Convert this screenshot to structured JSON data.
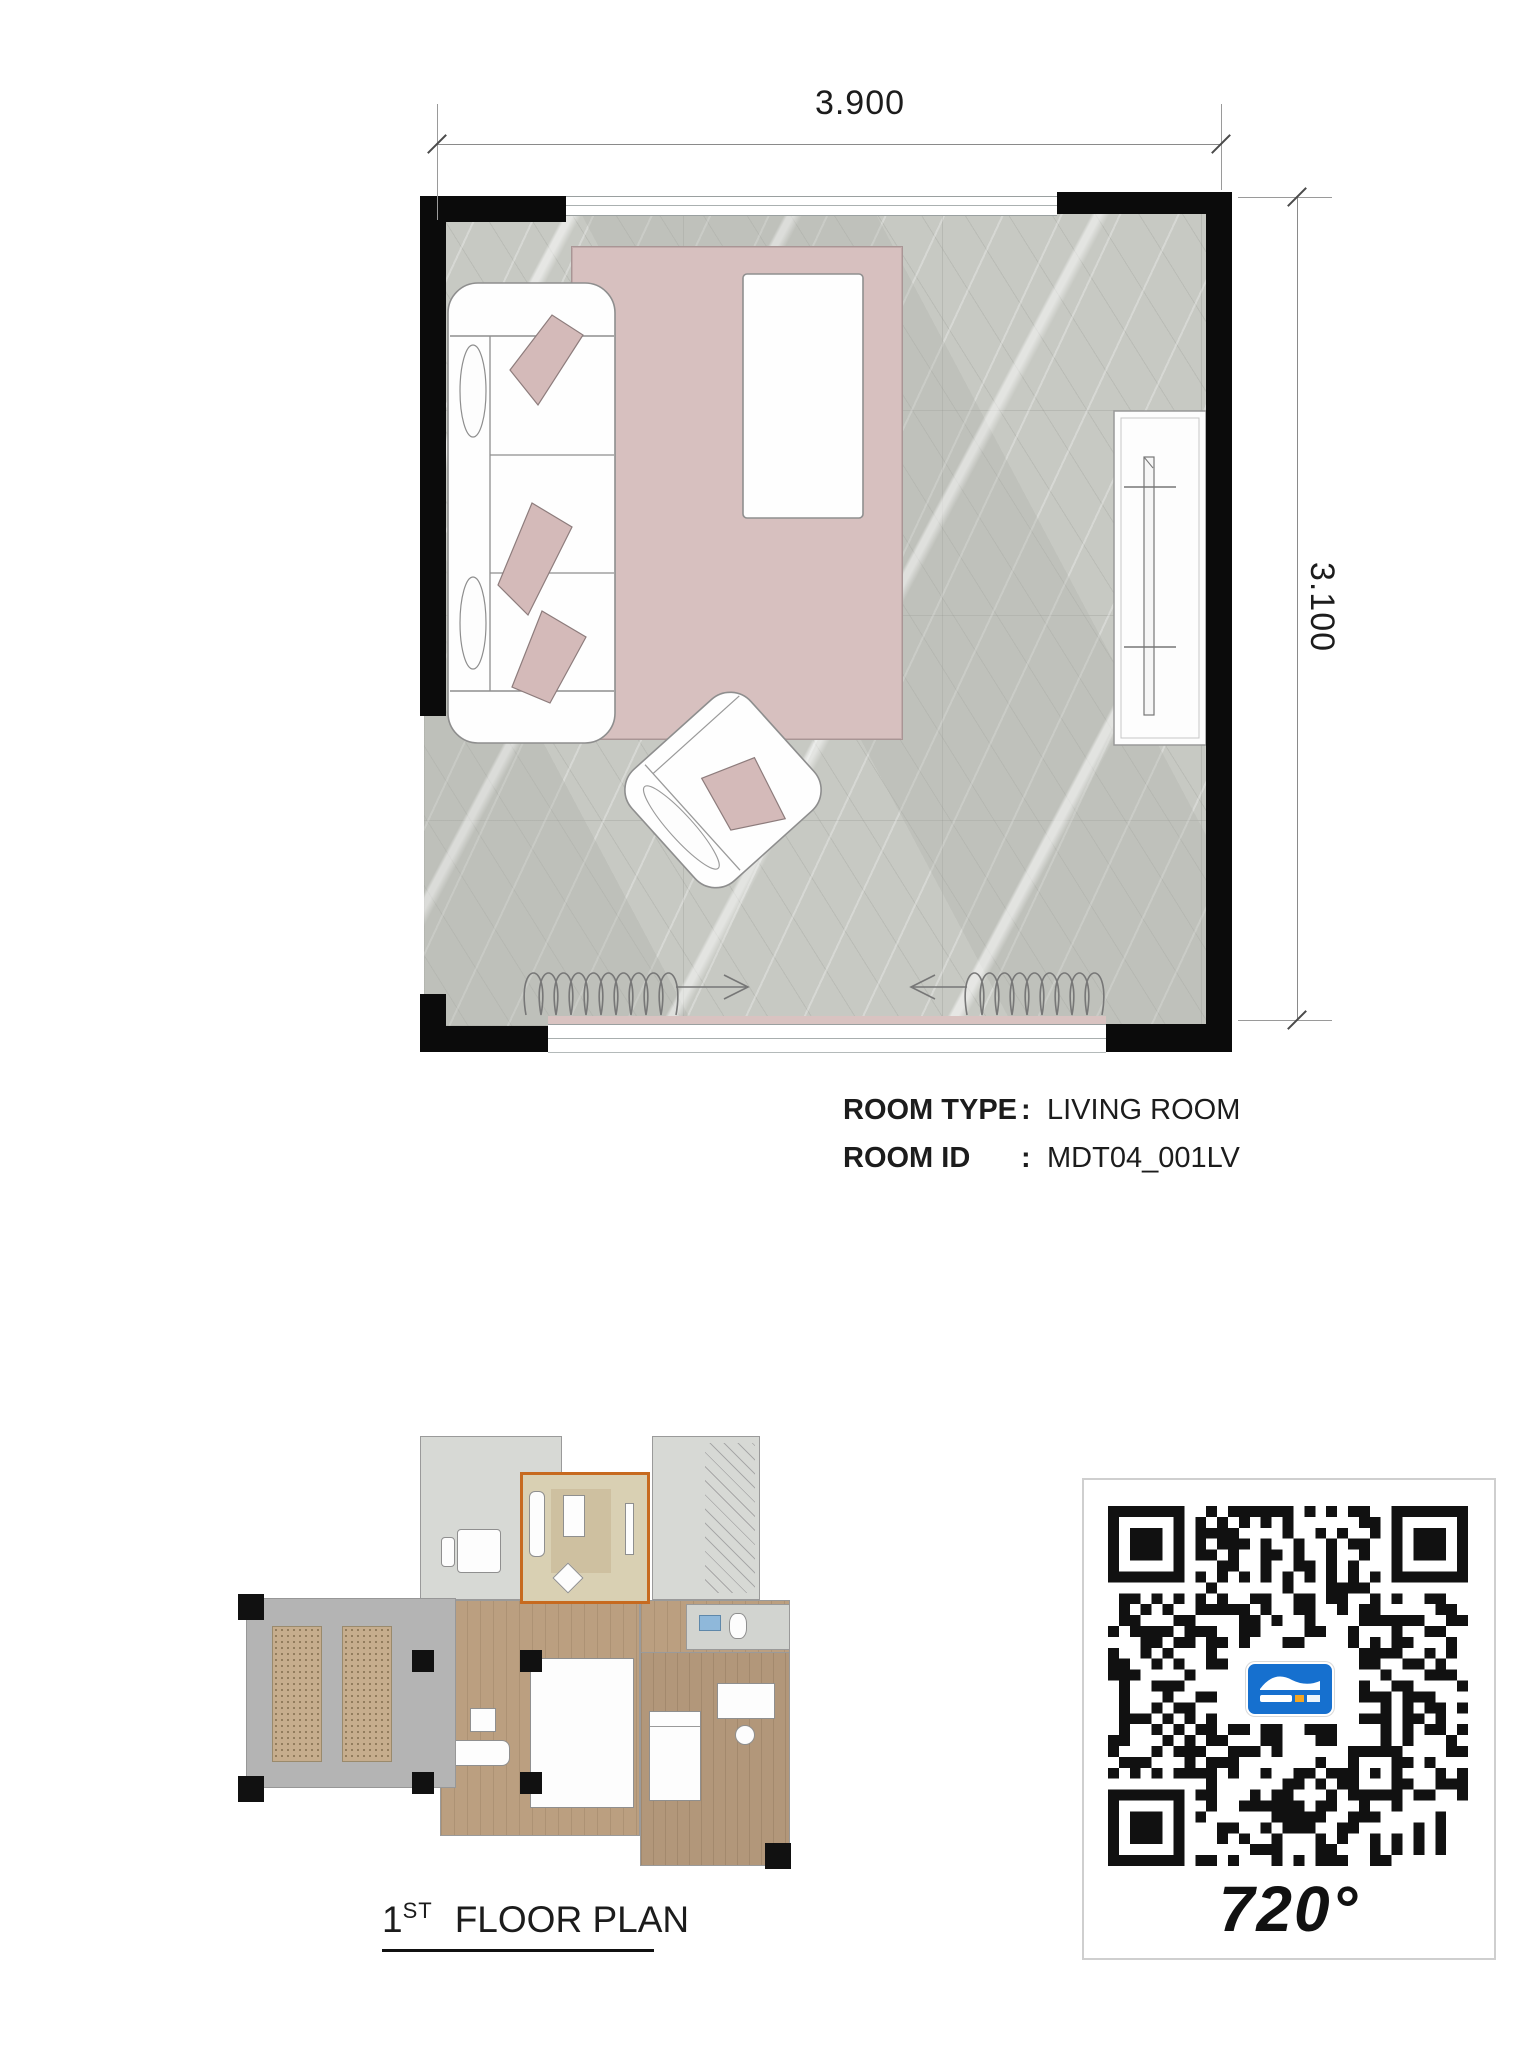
{
  "page": {
    "background": "#ffffff"
  },
  "main_plan": {
    "dimension_top_label": "3.900",
    "dimension_right_label": "3.100",
    "furniture": [
      "sofa",
      "pillows",
      "coffee-table",
      "rug",
      "armchair",
      "tv-console",
      "curtains",
      "windows"
    ]
  },
  "room_info": {
    "rows": [
      {
        "label": "ROOM TYPE",
        "separator": ":",
        "value": "LIVING ROOM"
      },
      {
        "label": "ROOM ID",
        "separator": ":",
        "value": "MDT04_001LV"
      }
    ]
  },
  "caption": {
    "number": "1",
    "ordinal": "ST",
    "title": "FLOOR PLAN"
  },
  "qr_card": {
    "label": "720°"
  },
  "colors": {
    "wall": "#0b0b0b",
    "rug_pink": "#d7c0bf",
    "marble_floor": "#c7c9c3",
    "highlight_orange": "#c76a1f",
    "qr_logo_blue": "#1670cf"
  }
}
